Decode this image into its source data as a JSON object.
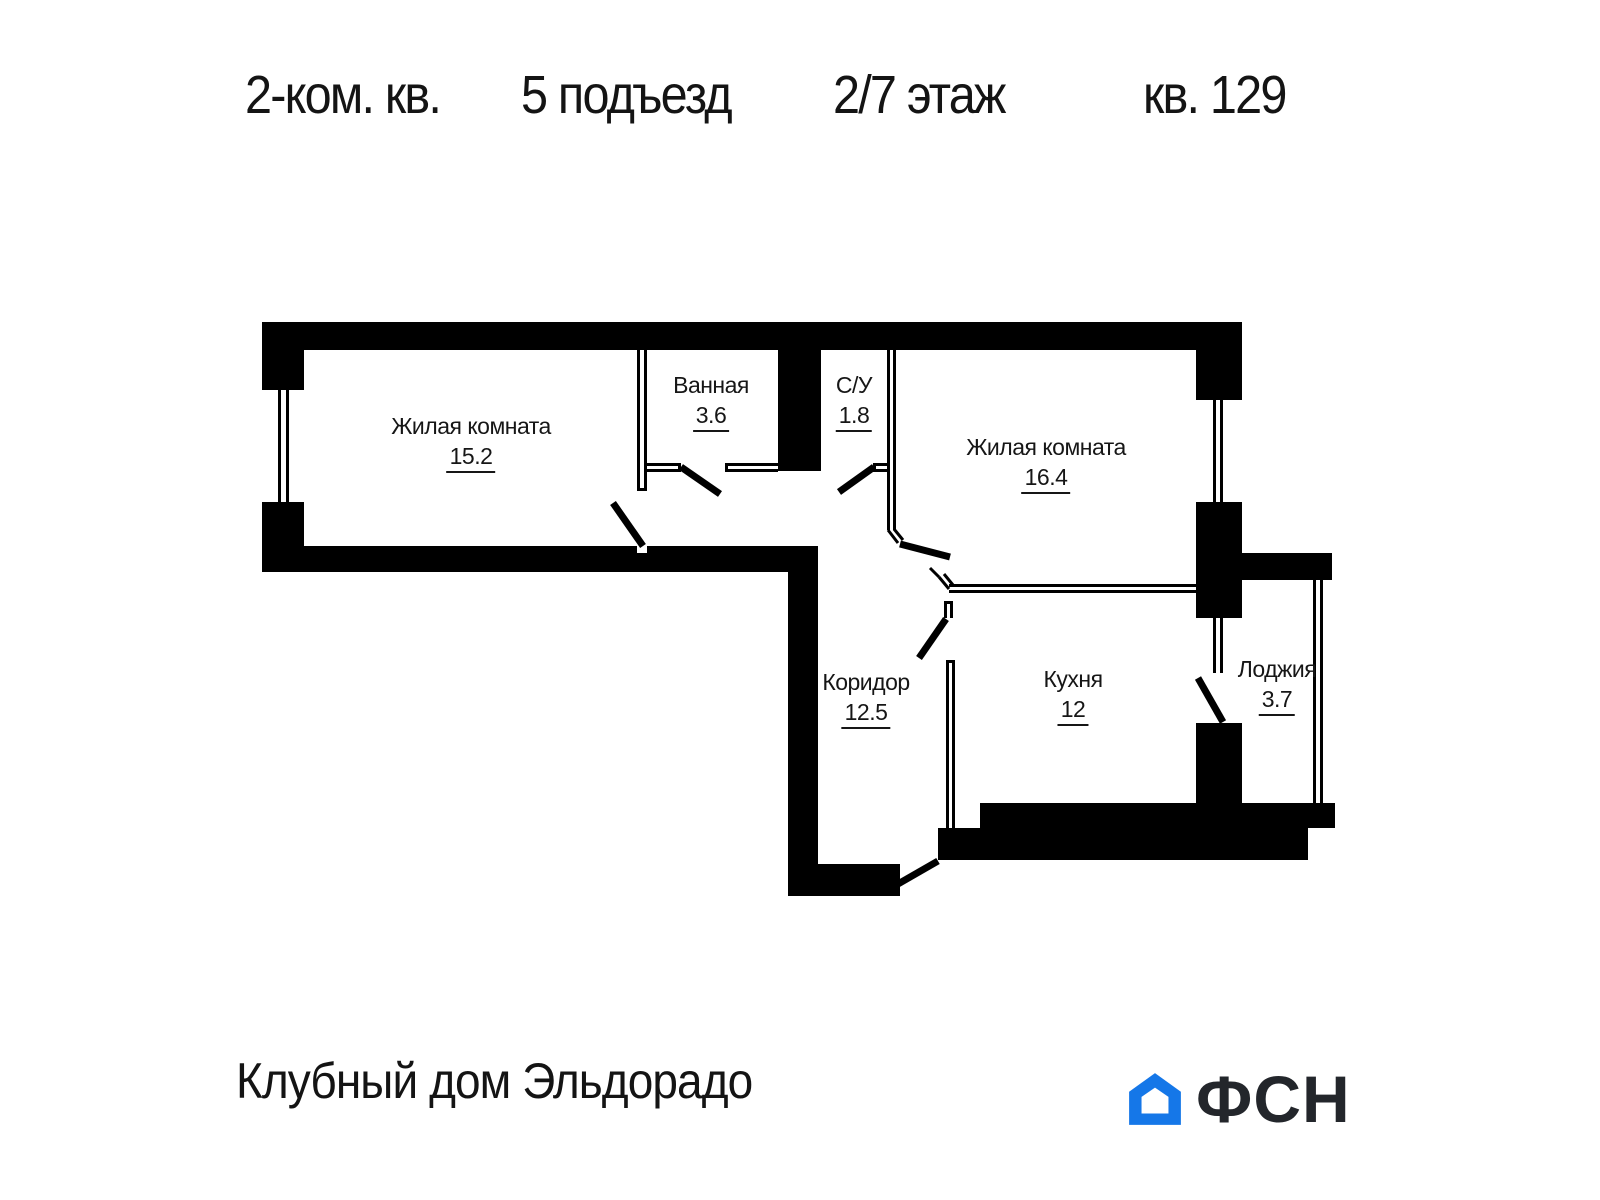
{
  "title": {
    "segments": [
      "2-ком. кв.",
      "5 подъезд",
      "2/7 этаж",
      "кв. 129"
    ]
  },
  "plan": {
    "rooms": [
      {
        "id": "living-room-1",
        "name": "Жилая комната",
        "area": "15.2"
      },
      {
        "id": "bathroom",
        "name": "Ванная",
        "area": "3.6"
      },
      {
        "id": "wc",
        "name": "С/У",
        "area": "1.8"
      },
      {
        "id": "living-room-2",
        "name": "Жилая комната",
        "area": "16.4"
      },
      {
        "id": "corridor",
        "name": "Коридор",
        "area": "12.5"
      },
      {
        "id": "kitchen",
        "name": "Кухня",
        "area": "12"
      },
      {
        "id": "loggia",
        "name": "Лоджия",
        "area": "3.7"
      }
    ]
  },
  "footer": {
    "project_name": "Клубный дом Эльдорадо",
    "logo_text": "ФСН"
  },
  "colors": {
    "walls": "#000000",
    "logo_blue": "#1577E8",
    "logo_text": "#23262B"
  },
  "icons": [
    "house-icon"
  ]
}
